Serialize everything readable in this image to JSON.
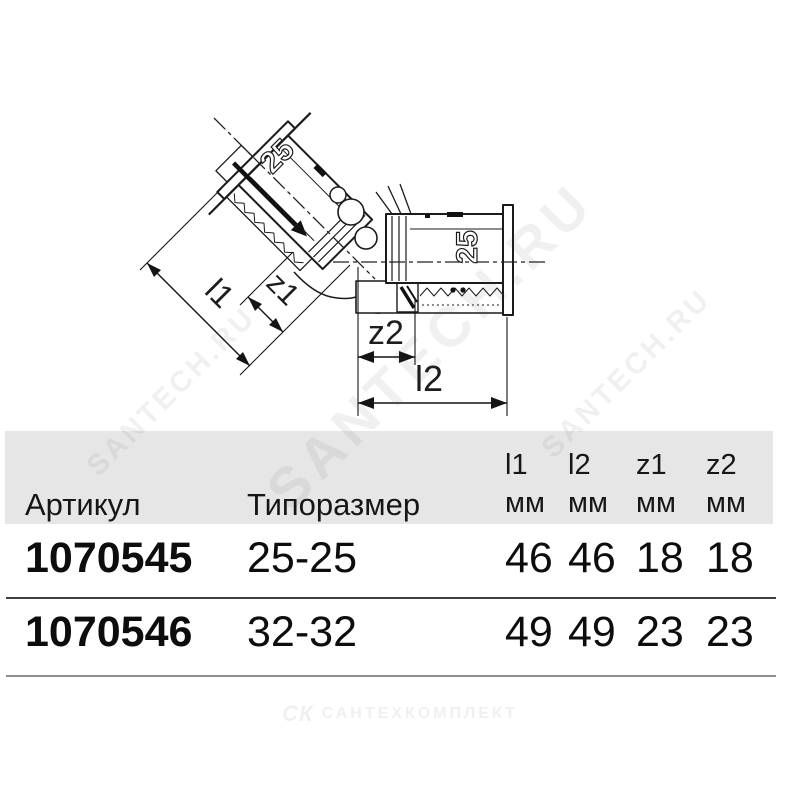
{
  "watermark": {
    "text": "SANTECH.RU",
    "color_hint": "#ececec"
  },
  "drawing": {
    "dimension_labels": {
      "l1": "l1",
      "z1": "z1",
      "z2": "z2",
      "l2": "l2"
    },
    "sleeve_marks": {
      "angled": "25",
      "horizontal": "25"
    },
    "line_color": "#1b1b1b"
  },
  "table": {
    "band_color": "#e6e6e6",
    "header": {
      "article": "Артикул",
      "size": "Типоразмер"
    },
    "dim_columns": [
      {
        "name": "l1",
        "unit": "мм"
      },
      {
        "name": "l2",
        "unit": "мм"
      },
      {
        "name": "z1",
        "unit": "мм"
      },
      {
        "name": "z2",
        "unit": "мм"
      }
    ],
    "rows": [
      {
        "article": "1070545",
        "size": "25-25",
        "values": [
          "46",
          "46",
          "18",
          "18"
        ]
      },
      {
        "article": "1070546",
        "size": "32-32",
        "values": [
          "49",
          "49",
          "23",
          "23"
        ]
      }
    ]
  },
  "footer": {
    "logo_icon": "СК",
    "logo_text": "САНТЕХКОМПЛЕКТ"
  }
}
